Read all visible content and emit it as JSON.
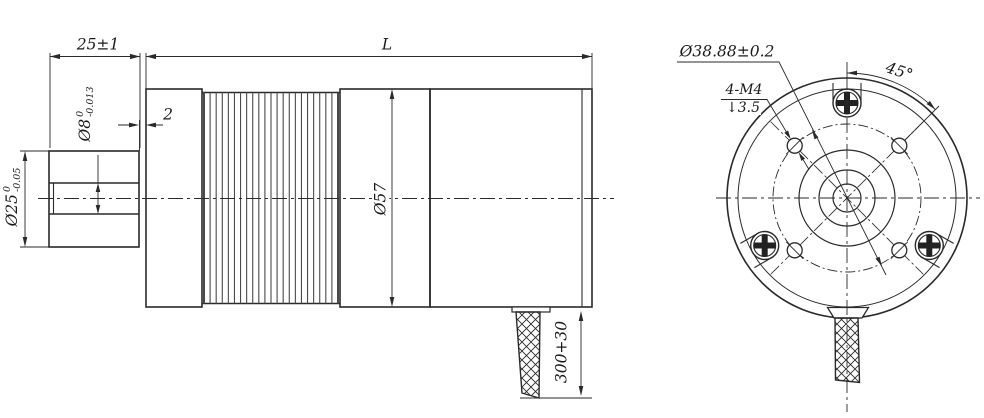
{
  "line_color": "#2a2a2a",
  "side_view": {
    "shaft_length_dim": "25±1",
    "overall_length_dim": "L",
    "boss_protrusion_dim": "2",
    "shaft_diameter": {
      "value": "Ø8",
      "tol_upper": "0",
      "tol_lower": "-0.013"
    },
    "boss_diameter": {
      "value": "Ø25",
      "tol_upper": "0",
      "tol_lower": "-0.05"
    },
    "body_diameter_dim": "Ø57",
    "cable_length_dim": "300+30"
  },
  "front_view": {
    "bolt_circle_dim": "Ø38.88±0.2",
    "mounting_holes_spec": "4-M4",
    "depth_symbol": "↓",
    "hole_depth": "3.5",
    "hole_angle_dim": "45°"
  }
}
